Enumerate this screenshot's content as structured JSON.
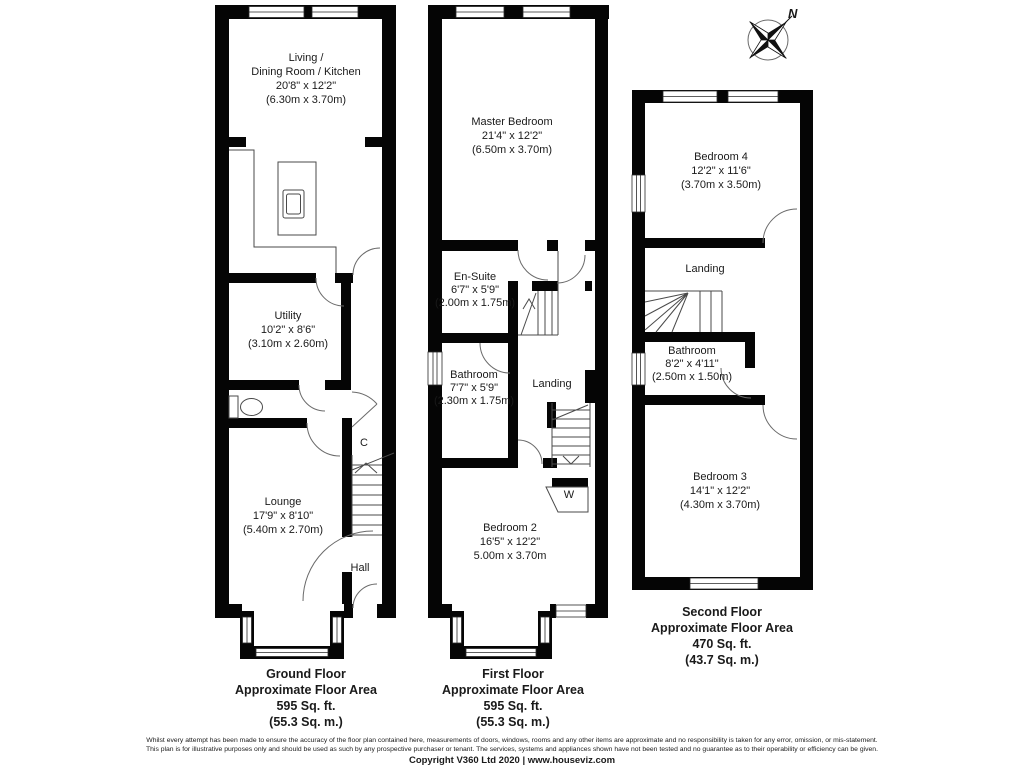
{
  "compass": {
    "north_label": "N"
  },
  "ground": {
    "living_line1": "Living /",
    "living_line2": "Dining Room / Kitchen",
    "living_dims": "20'8\" x 12'2\"",
    "living_metric": "(6.30m x 3.70m)",
    "utility_name": "Utility",
    "utility_dims": "10'2\" x 8'6\"",
    "utility_metric": "(3.10m x 2.60m)",
    "cupboard_label": "C",
    "lounge_name": "Lounge",
    "lounge_dims": "17'9\" x 8'10\"",
    "lounge_metric": "(5.40m x 2.70m)",
    "hall_label": "Hall",
    "area_line1": "Ground Floor",
    "area_line2": "Approximate Floor Area",
    "area_line3": "595 Sq. ft.",
    "area_line4": "(55.3 Sq. m.)"
  },
  "first": {
    "master_name": "Master Bedroom",
    "master_dims": "21'4\" x 12'2\"",
    "master_metric": "(6.50m x 3.70m)",
    "ensuite_name": "En-Suite",
    "ensuite_dims": "6'7\" x 5'9\"",
    "ensuite_metric": "(2.00m x 1.75m)",
    "bathroom_name": "Bathroom",
    "bathroom_dims": "7'7\" x 5'9\"",
    "bathroom_metric": "(2.30m x 1.75m)",
    "landing_label": "Landing",
    "wardrobe_label": "W",
    "bedroom2_name": "Bedroom 2",
    "bedroom2_dims": "16'5\" x 12'2\"",
    "bedroom2_metric": "5.00m x 3.70m",
    "area_line1": "First Floor",
    "area_line2": "Approximate Floor Area",
    "area_line3": "595 Sq. ft.",
    "area_line4": "(55.3 Sq. m.)"
  },
  "second": {
    "bedroom4_name": "Bedroom 4",
    "bedroom4_dims": "12'2\" x 11'6\"",
    "bedroom4_metric": "(3.70m x 3.50m)",
    "landing_label": "Landing",
    "bathroom_name": "Bathroom",
    "bathroom_dims": "8'2\" x 4'11\"",
    "bathroom_metric": "(2.50m x 1.50m)",
    "bedroom3_name": "Bedroom 3",
    "bedroom3_dims": "14'1\" x 12'2\"",
    "bedroom3_metric": "(4.30m x 3.70m)",
    "area_line1": "Second Floor",
    "area_line2": "Approximate Floor Area",
    "area_line3": "470 Sq. ft.",
    "area_line4": "(43.7 Sq. m.)"
  },
  "footer": {
    "disclaimer_line1": "Whilst every attempt has been made to ensure the accuracy of the floor plan contained here, measurements of doors, windows, rooms and any other items are approximate and no responsibility is taken for any error, omission, or mis-statement.",
    "disclaimer_line2": "This plan is for illustrative purposes only and should be used as such by any prospective purchaser or tenant. The services, systems and appliances shown have not been tested and no guarantee as to their operability or efficiency can be given.",
    "copyright": "Copyright V360 Ltd 2020 | www.houseviz.com"
  }
}
